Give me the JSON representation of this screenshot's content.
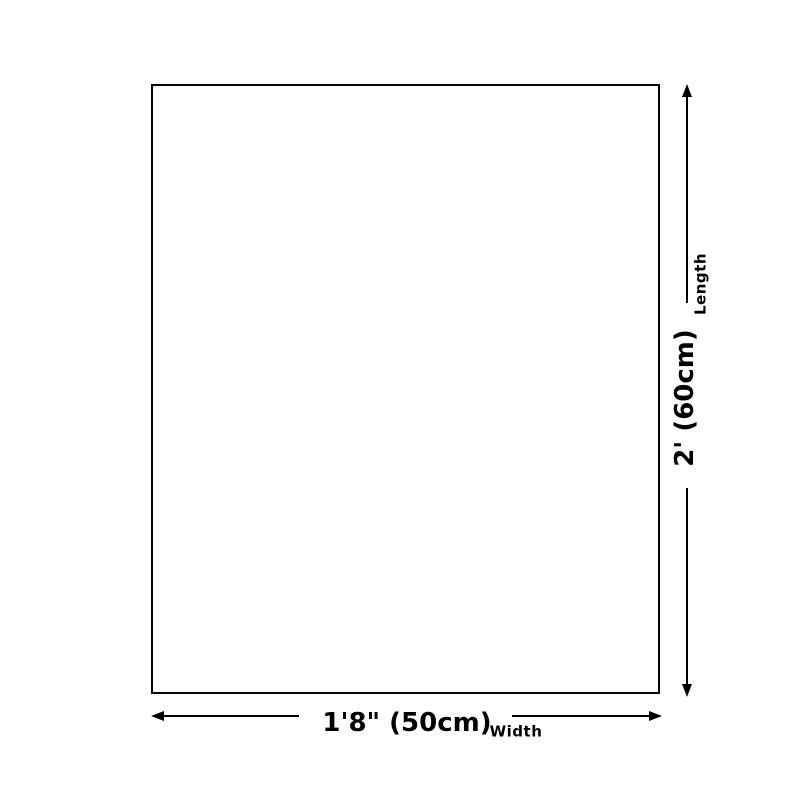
{
  "diagram": {
    "type": "product-size-diagram",
    "background_color": "#ffffff",
    "line_color": "#000000",
    "shape": "rectangle"
  },
  "dimensions": {
    "length": {
      "axis_label": "Length",
      "value": "2' (60cm)"
    },
    "width": {
      "axis_label": "Width",
      "value": "1'8\" (50cm)"
    }
  }
}
